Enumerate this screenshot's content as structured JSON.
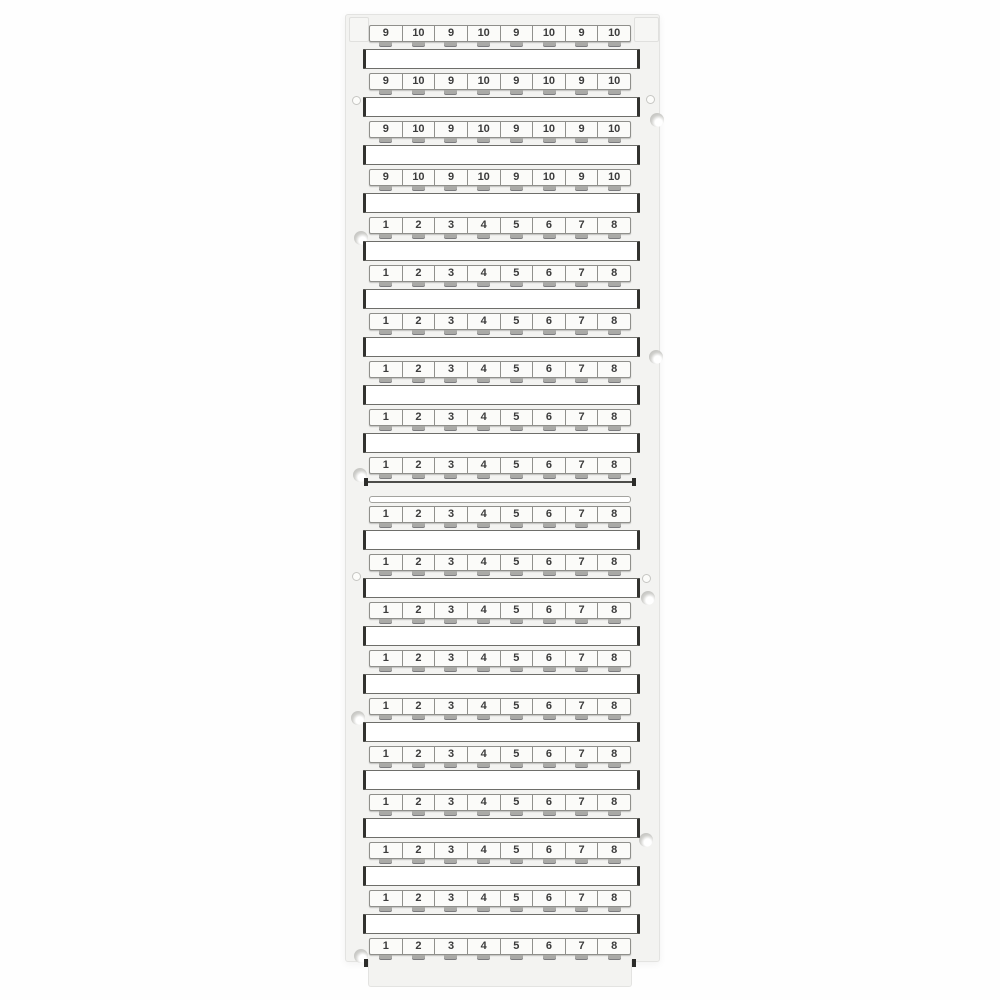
{
  "colors": {
    "page_background": "#ffffff",
    "card_background": "#f3f3f1",
    "tag_background": "#fbfbf9",
    "tag_border": "#8f8f8b",
    "tag_text": "#3c3c3c",
    "blank_strip_background": "#ffffff",
    "blank_strip_border": "#32322f",
    "hole_gray": "#c6c6c3"
  },
  "card": {
    "sections": [
      {
        "id": "upper-card",
        "rows": [
          {
            "cells": [
              "9",
              "10",
              "9",
              "10",
              "9",
              "10",
              "9",
              "10"
            ]
          },
          {
            "cells": [
              "9",
              "10",
              "9",
              "10",
              "9",
              "10",
              "9",
              "10"
            ]
          },
          {
            "cells": [
              "9",
              "10",
              "9",
              "10",
              "9",
              "10",
              "9",
              "10"
            ]
          },
          {
            "cells": [
              "9",
              "10",
              "9",
              "10",
              "9",
              "10",
              "9",
              "10"
            ]
          },
          {
            "cells": [
              "1",
              "2",
              "3",
              "4",
              "5",
              "6",
              "7",
              "8"
            ]
          },
          {
            "cells": [
              "1",
              "2",
              "3",
              "4",
              "5",
              "6",
              "7",
              "8"
            ]
          },
          {
            "cells": [
              "1",
              "2",
              "3",
              "4",
              "5",
              "6",
              "7",
              "8"
            ]
          },
          {
            "cells": [
              "1",
              "2",
              "3",
              "4",
              "5",
              "6",
              "7",
              "8"
            ]
          },
          {
            "cells": [
              "1",
              "2",
              "3",
              "4",
              "5",
              "6",
              "7",
              "8"
            ]
          },
          {
            "cells": [
              "1",
              "2",
              "3",
              "4",
              "5",
              "6",
              "7",
              "8"
            ]
          }
        ]
      },
      {
        "id": "lower-card",
        "rows": [
          {
            "cells": [
              "1",
              "2",
              "3",
              "4",
              "5",
              "6",
              "7",
              "8"
            ]
          },
          {
            "cells": [
              "1",
              "2",
              "3",
              "4",
              "5",
              "6",
              "7",
              "8"
            ]
          },
          {
            "cells": [
              "1",
              "2",
              "3",
              "4",
              "5",
              "6",
              "7",
              "8"
            ]
          },
          {
            "cells": [
              "1",
              "2",
              "3",
              "4",
              "5",
              "6",
              "7",
              "8"
            ]
          },
          {
            "cells": [
              "1",
              "2",
              "3",
              "4",
              "5",
              "6",
              "7",
              "8"
            ]
          },
          {
            "cells": [
              "1",
              "2",
              "3",
              "4",
              "5",
              "6",
              "7",
              "8"
            ]
          },
          {
            "cells": [
              "1",
              "2",
              "3",
              "4",
              "5",
              "6",
              "7",
              "8"
            ]
          },
          {
            "cells": [
              "1",
              "2",
              "3",
              "4",
              "5",
              "6",
              "7",
              "8"
            ]
          },
          {
            "cells": [
              "1",
              "2",
              "3",
              "4",
              "5",
              "6",
              "7",
              "8"
            ]
          },
          {
            "cells": [
              "1",
              "2",
              "3",
              "4",
              "5",
              "6",
              "7",
              "8"
            ]
          }
        ]
      }
    ]
  }
}
